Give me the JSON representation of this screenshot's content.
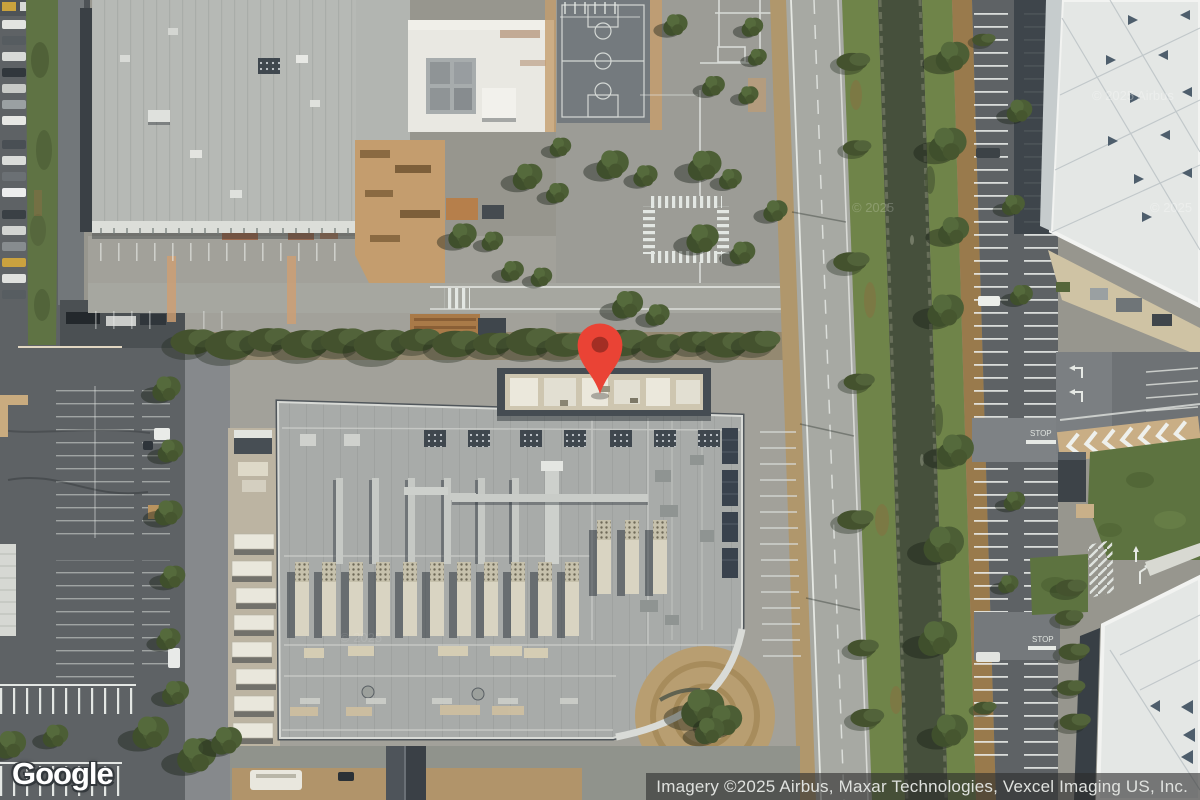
{
  "map": {
    "view_type": "satellite",
    "logo": "Google",
    "attribution": "Imagery ©2025 Airbus, Maxar Technologies, Vexcel Imaging US, Inc.",
    "watermarks": [
      "© 2025",
      "© 2025 Airbus",
      "© 2025",
      "© 2025"
    ],
    "road_markings": {
      "stop": "STOP"
    }
  },
  "marker": {
    "tip_x": 600,
    "tip_y": 394,
    "style": "left:572px;top:320px;width:56px;height:74px",
    "color": "#EA4335",
    "inner_color": "#A32E24"
  },
  "colors": {
    "base": "#97968e",
    "apron": "#a2a19a",
    "lot_dark": "#5e6265",
    "roof_a": "#b6b9b5",
    "roof_g": "#a8aba9",
    "white_roof": "#e4e7e5",
    "white_bldg": "#e9e8e2",
    "court": "#747a7e",
    "road": "#a7a9a3",
    "shoulder_dirt": "#b0976c",
    "grass_bank": "#6f8449",
    "water": "#46503c",
    "brush": "#997a4c",
    "dirt": "#c49d6e",
    "lawn": "#5d7340",
    "pin-red": "#EA4335",
    "pin-inner": "#A32E24",
    "attr_bg": "rgba(44,44,44,0.6)",
    "attr_fg": "#dfe1de"
  }
}
